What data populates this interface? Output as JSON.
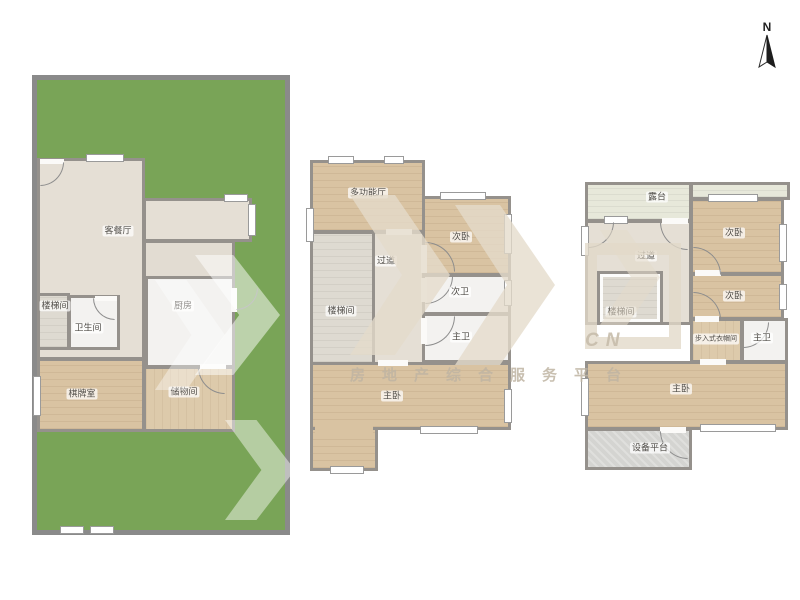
{
  "compass": {
    "north": "N"
  },
  "watermark": {
    "domain": "CN",
    "tagline": "房地产综合服务平台"
  },
  "colors": {
    "lawn": "#79a457",
    "wood_floor": "#d9c3a2",
    "wall": "#8f8f8f",
    "tile_floor": "#f3f2f0",
    "hall_floor": "#e5dfd5",
    "terrace_floor": "#e7e8da",
    "watermark": "#e2d9c8"
  },
  "floor1": {
    "living": "客餐厅",
    "stair": "楼梯间",
    "bath": "卫生间",
    "kitchen": "厨房",
    "game_room": "棋牌室",
    "storage": "储物间"
  },
  "floor2": {
    "multi_room": "多功能厅",
    "bedroom": "次卧",
    "corridor": "过道",
    "stair": "楼梯间",
    "bath_second": "次卫",
    "bath_master": "主卫",
    "master": "主卧"
  },
  "floor3": {
    "terrace": "露台",
    "bedroom_a": "次卧",
    "bedroom_b": "次卧",
    "corridor": "过道",
    "stair": "楼梯间",
    "closet": "步入式衣帽间",
    "bath_master": "主卫",
    "master": "主卧",
    "equipment": "设备平台"
  }
}
